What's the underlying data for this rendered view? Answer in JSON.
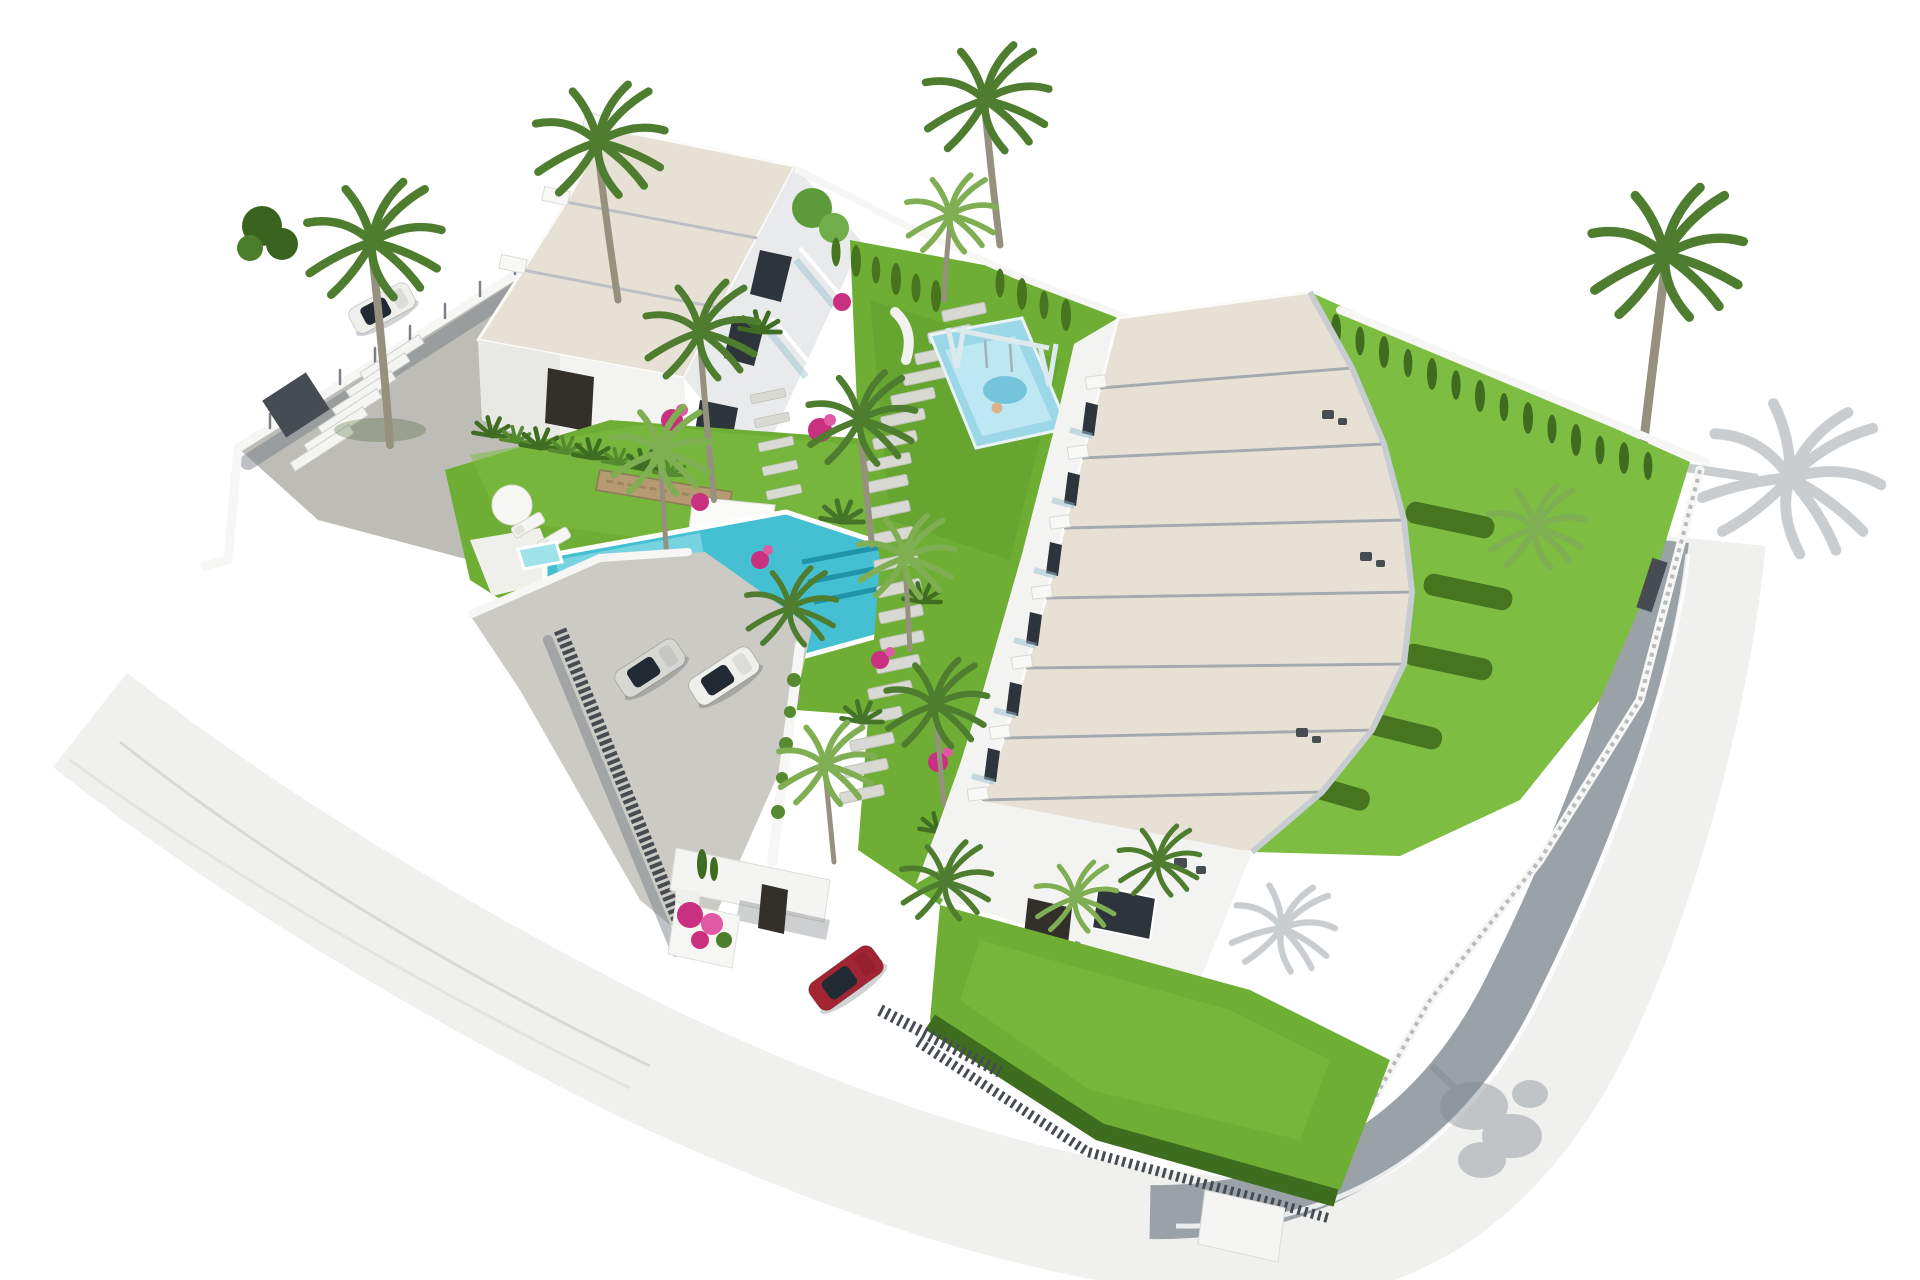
{
  "title": "Aerial 3D architectural render of a coastal residential development with two white buildings, gardens and pool",
  "colors": {
    "background": "#ffffff",
    "roof_gravel": "#e7e1d5",
    "wall_white": "#f3f3f1",
    "facade_shade": "#e9eaec",
    "window_dark": "#2e343b",
    "door_dark": "#33302b",
    "gravel_lot": "#bdbcb7",
    "plaza_paving": "#cbcac5",
    "driveway": "#c4c3be",
    "road_asphalt": "#9aa1a7",
    "sidewalk": "#f0f0ee",
    "path_stone": "#d9d9d4",
    "lawn": "#6fae35",
    "lawn_light": "#7cbd42",
    "lawn_dark": "#5e9c2b",
    "hedge_dark": "#3f6d1f",
    "cypress": "#47751f",
    "palm_dark": "#4e7d2f",
    "palm_light": "#7fae53",
    "trunk": "#96907e",
    "pool_water": "#45c0d2",
    "pool_shallow": "#9ee2ea",
    "pool_steps": "#1f93a8",
    "kids_pool": "#9bd7e6",
    "kids_pool_light": "#bde7f2",
    "stone_wall": "#b59a72",
    "bougainvillea": "#c9307f",
    "bougainvillea_light": "#e059a5",
    "car_silver": "#d7d7d4",
    "car_white": "#efefec",
    "car_red": "#a32432",
    "fence_dark": "#474c52",
    "shadow": "#7e8890",
    "swing_frame": "#dceaee"
  },
  "scene": {
    "site": {
      "plot": "curved corner plot on sloping ground",
      "boundary": "white perimeter walls with dark metal fencing and a curved road on two sides"
    },
    "building_a": {
      "label": "villa-block-a",
      "units": 3,
      "storeys": 2,
      "roof": "stepped flat gravel roofs with white parapets",
      "features": [
        "garden-facing balconies",
        "dark entry door",
        "agave hedge at base"
      ]
    },
    "building_b": {
      "label": "townhouse-row-b",
      "units": 8,
      "storeys": 2,
      "roof": "stepped flat gravel roofs descending along the slope",
      "features": [
        "private rear gardens with box hedges",
        "terraces with dark outdoor furniture",
        "ground-floor entrance at the lower end"
      ]
    },
    "amenities": {
      "pool": {
        "shape": "angled lap pool widening at the right end",
        "steps": 3,
        "spa_corner": true
      },
      "sun_deck": {
        "loungers": 5,
        "parasols": 1,
        "dining_tables": 1
      },
      "playground": {
        "kids_pool": true,
        "swing_frame": true,
        "slide": true
      },
      "paths": "stepped stone walkways winding through the gardens"
    },
    "parking": {
      "gravel_lot_cars": 1,
      "plaza_cars": 2,
      "arriving_car": 1
    },
    "cars": [
      {
        "id": "white-suv-gravel-lot",
        "color_key": "car_white"
      },
      {
        "id": "silver-sedan-plaza",
        "color_key": "car_silver"
      },
      {
        "id": "white-sedan-plaza",
        "color_key": "car_white"
      },
      {
        "id": "red-car-entrance",
        "color_key": "car_red"
      }
    ],
    "vegetation": {
      "tall_palms": 16,
      "cypress_row": true,
      "box_hedges": true,
      "bougainvillea_clusters": 8,
      "agave_row": true,
      "banana_plants": true
    },
    "lighting": {
      "sun": "high upper-right",
      "shadows": [
        "large palm shadow on white pavement right of plot",
        "bushy tree shadow on lower road",
        "soft shadows left of walls"
      ]
    }
  }
}
